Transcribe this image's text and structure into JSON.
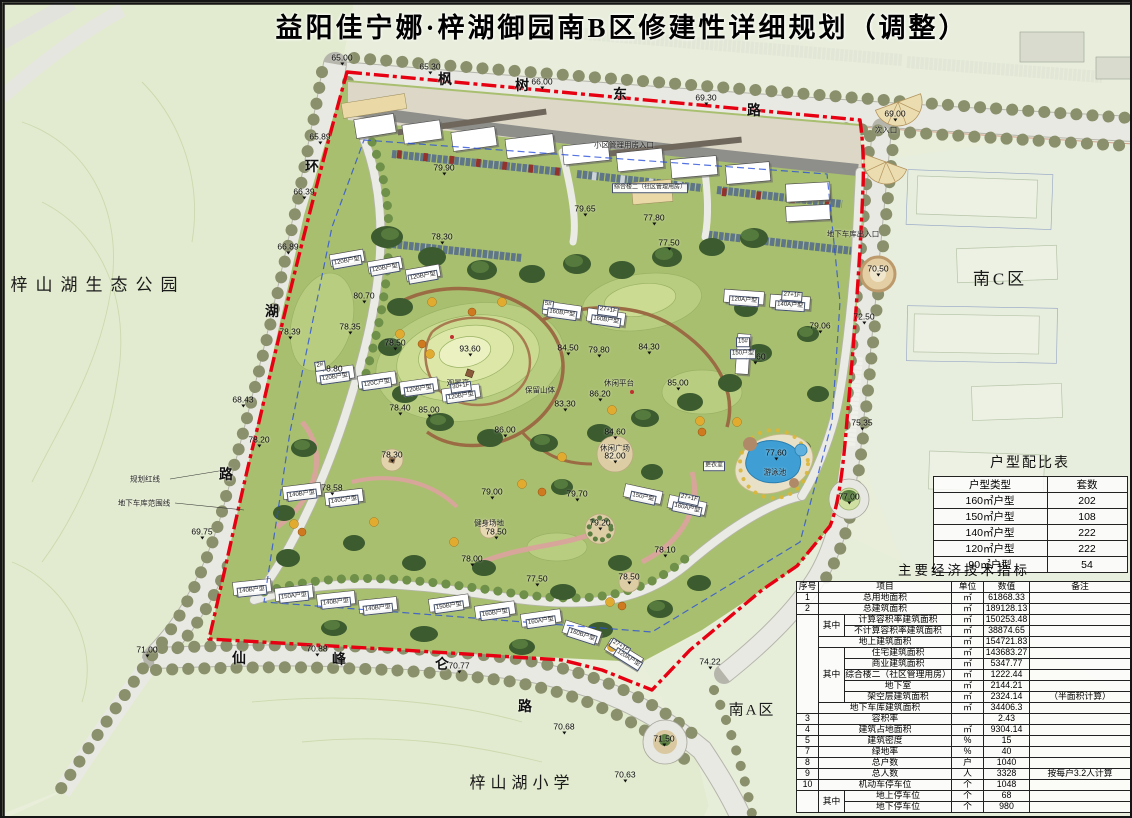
{
  "title": "益阳佳宁娜·梓湖御园南B区修建性详细规划（调整）",
  "colors": {
    "boundary_red": "#e60012",
    "garage_blue": "#2b50d9",
    "pool_blue": "#3f9fd4"
  },
  "area_labels": [
    {
      "t": "梓山湖生态公园",
      "x": 96,
      "y": 281,
      "fs": 17,
      "ls": 8
    },
    {
      "t": "南C区",
      "x": 998,
      "y": 275,
      "fs": 17,
      "ls": 3
    },
    {
      "t": "南A区",
      "x": 750,
      "y": 707,
      "fs": 15,
      "ls": 2
    },
    {
      "t": "梓山湖小学",
      "x": 520,
      "y": 779,
      "fs": 16,
      "ls": 5
    }
  ],
  "road_labels": [
    {
      "t": "枫",
      "x": 443,
      "y": 77
    },
    {
      "t": "树",
      "x": 520,
      "y": 83
    },
    {
      "t": "东",
      "x": 618,
      "y": 92
    },
    {
      "t": "路",
      "x": 752,
      "y": 108
    },
    {
      "t": "环",
      "x": 310,
      "y": 164
    },
    {
      "t": "湖",
      "x": 270,
      "y": 309
    },
    {
      "t": "路",
      "x": 224,
      "y": 472
    },
    {
      "t": "仙",
      "x": 237,
      "y": 656
    },
    {
      "t": "峰",
      "x": 337,
      "y": 657
    },
    {
      "t": "仑",
      "x": 440,
      "y": 662
    },
    {
      "t": "路",
      "x": 523,
      "y": 704
    }
  ],
  "note_labels": [
    {
      "t": "规划红线",
      "x": 143,
      "y": 477
    },
    {
      "t": "地下车库范围线",
      "x": 142,
      "y": 501
    },
    {
      "t": "游泳池",
      "x": 773,
      "y": 470
    },
    {
      "t": "休闲广场",
      "x": 613,
      "y": 446
    },
    {
      "t": "健身场地",
      "x": 487,
      "y": 521
    },
    {
      "t": "观景亭",
      "x": 456,
      "y": 381
    },
    {
      "t": "保留山体",
      "x": 538,
      "y": 388
    },
    {
      "t": "休闲平台",
      "x": 617,
      "y": 381
    },
    {
      "t": "次入口",
      "x": 884,
      "y": 128
    },
    {
      "t": "小区管理用房入口",
      "x": 622,
      "y": 143
    },
    {
      "t": "地下车库出入口",
      "x": 851,
      "y": 232
    },
    {
      "t": "更衣室",
      "x": 712,
      "y": 464,
      "cls": "bldg"
    },
    {
      "t": "综合楼二（社区管理用房）",
      "x": 648,
      "y": 186,
      "cls": "bldg"
    }
  ],
  "elevations": [
    {
      "t": "65.00",
      "x": 340,
      "y": 57
    },
    {
      "t": "65.30",
      "x": 428,
      "y": 66
    },
    {
      "t": "66.00",
      "x": 540,
      "y": 81
    },
    {
      "t": "69.30",
      "x": 704,
      "y": 97
    },
    {
      "t": "69.00",
      "x": 893,
      "y": 113
    },
    {
      "t": "65.89",
      "x": 318,
      "y": 136
    },
    {
      "t": "66.39",
      "x": 302,
      "y": 191
    },
    {
      "t": "66.89",
      "x": 286,
      "y": 246
    },
    {
      "t": "68.43",
      "x": 241,
      "y": 399
    },
    {
      "t": "78.39",
      "x": 288,
      "y": 331
    },
    {
      "t": "78.20",
      "x": 257,
      "y": 439
    },
    {
      "t": "69.75",
      "x": 200,
      "y": 531
    },
    {
      "t": "71.00",
      "x": 145,
      "y": 649
    },
    {
      "t": "70.88",
      "x": 315,
      "y": 648
    },
    {
      "t": "70.77",
      "x": 457,
      "y": 665
    },
    {
      "t": "70.68",
      "x": 562,
      "y": 726
    },
    {
      "t": "70.63",
      "x": 623,
      "y": 774
    },
    {
      "t": "74.22",
      "x": 708,
      "y": 661
    },
    {
      "t": "71.50",
      "x": 662,
      "y": 738
    },
    {
      "t": "70.50",
      "x": 876,
      "y": 268
    },
    {
      "t": "72.50",
      "x": 862,
      "y": 316
    },
    {
      "t": "79.06",
      "x": 818,
      "y": 325
    },
    {
      "t": "75.35",
      "x": 860,
      "y": 422
    },
    {
      "t": "77.00",
      "x": 847,
      "y": 496
    },
    {
      "t": "77.60",
      "x": 774,
      "y": 452
    },
    {
      "t": "79.00",
      "x": 788,
      "y": 302
    },
    {
      "t": "79.60",
      "x": 753,
      "y": 356
    },
    {
      "t": "93.60",
      "x": 468,
      "y": 348
    },
    {
      "t": "84.50",
      "x": 566,
      "y": 347
    },
    {
      "t": "79.80",
      "x": 597,
      "y": 349
    },
    {
      "t": "84.30",
      "x": 647,
      "y": 346
    },
    {
      "t": "86.20",
      "x": 598,
      "y": 393
    },
    {
      "t": "83.30",
      "x": 563,
      "y": 403
    },
    {
      "t": "85.00",
      "x": 676,
      "y": 382
    },
    {
      "t": "84.60",
      "x": 613,
      "y": 431
    },
    {
      "t": "86.00",
      "x": 503,
      "y": 429
    },
    {
      "t": "85.00",
      "x": 427,
      "y": 409
    },
    {
      "t": "82.00",
      "x": 613,
      "y": 455
    },
    {
      "t": "79.70",
      "x": 575,
      "y": 493
    },
    {
      "t": "79.00",
      "x": 490,
      "y": 491
    },
    {
      "t": "78.50",
      "x": 494,
      "y": 531
    },
    {
      "t": "79.20",
      "x": 598,
      "y": 522
    },
    {
      "t": "78.00",
      "x": 470,
      "y": 558
    },
    {
      "t": "77.50",
      "x": 535,
      "y": 578
    },
    {
      "t": "78.10",
      "x": 663,
      "y": 549
    },
    {
      "t": "78.50",
      "x": 627,
      "y": 576
    },
    {
      "t": "78.30",
      "x": 390,
      "y": 454
    },
    {
      "t": "78.40",
      "x": 398,
      "y": 407
    },
    {
      "t": "80.70",
      "x": 362,
      "y": 295
    },
    {
      "t": "78.35",
      "x": 348,
      "y": 326
    },
    {
      "t": "79.90",
      "x": 442,
      "y": 167
    },
    {
      "t": "78.30",
      "x": 440,
      "y": 236
    },
    {
      "t": "79.65",
      "x": 583,
      "y": 208
    },
    {
      "t": "77.80",
      "x": 652,
      "y": 217
    },
    {
      "t": "77.50",
      "x": 667,
      "y": 242
    },
    {
      "t": "78.50",
      "x": 393,
      "y": 342
    },
    {
      "t": "78.80",
      "x": 330,
      "y": 368
    },
    {
      "t": "78.58",
      "x": 330,
      "y": 487
    }
  ],
  "bldg_labels": [
    {
      "t": "120B户型",
      "x": 345,
      "y": 260,
      "r": -10
    },
    {
      "t": "120B户型",
      "x": 383,
      "y": 267,
      "r": -10
    },
    {
      "t": "120B户型",
      "x": 421,
      "y": 275,
      "r": -10
    },
    {
      "t": "2#",
      "x": 318,
      "y": 364,
      "r": -8
    },
    {
      "t": "120B户型",
      "x": 333,
      "y": 376,
      "r": -8
    },
    {
      "t": "120C户型",
      "x": 375,
      "y": 382,
      "r": -8
    },
    {
      "t": "120B户型",
      "x": 417,
      "y": 388,
      "r": -8
    },
    {
      "t": "30+1F",
      "x": 459,
      "y": 385,
      "r": -8
    },
    {
      "t": "120B户型",
      "x": 459,
      "y": 395,
      "r": -8
    },
    {
      "t": "140B户型",
      "x": 300,
      "y": 493,
      "r": -7
    },
    {
      "t": "140C户型",
      "x": 342,
      "y": 499,
      "r": -7
    },
    {
      "t": "140B户型",
      "x": 250,
      "y": 589,
      "r": -6
    },
    {
      "t": "150A户型",
      "x": 292,
      "y": 595,
      "r": -6
    },
    {
      "t": "140B户型",
      "x": 334,
      "y": 601,
      "r": -6
    },
    {
      "t": "140B户型",
      "x": 376,
      "y": 607,
      "r": -6
    },
    {
      "t": "150B户型",
      "x": 447,
      "y": 605,
      "r": -8
    },
    {
      "t": "160B户型",
      "x": 493,
      "y": 612,
      "r": -8
    },
    {
      "t": "160A户型",
      "x": 539,
      "y": 620,
      "r": -8
    },
    {
      "t": "160B户型",
      "x": 580,
      "y": 634,
      "r": 18
    },
    {
      "t": "27+1F",
      "x": 618,
      "y": 645,
      "r": 32
    },
    {
      "t": "120A户型",
      "x": 626,
      "y": 657,
      "r": 32
    },
    {
      "t": "150户型",
      "x": 641,
      "y": 496,
      "r": 12
    },
    {
      "t": "27+1F",
      "x": 687,
      "y": 497,
      "r": 12
    },
    {
      "t": "160A户型",
      "x": 685,
      "y": 507,
      "r": 12
    },
    {
      "t": "5#",
      "x": 546,
      "y": 303,
      "r": 8
    },
    {
      "t": "160B户型",
      "x": 560,
      "y": 312,
      "r": 8
    },
    {
      "t": "27+1F",
      "x": 606,
      "y": 309,
      "r": 8
    },
    {
      "t": "160B户型",
      "x": 604,
      "y": 319,
      "r": 8
    },
    {
      "t": "27+1F",
      "x": 790,
      "y": 294,
      "r": 4
    },
    {
      "t": "120A户型",
      "x": 742,
      "y": 299,
      "r": 4
    },
    {
      "t": "140A户型",
      "x": 788,
      "y": 304,
      "r": 4
    },
    {
      "t": "15#",
      "x": 741,
      "y": 340,
      "r": 0
    },
    {
      "t": "150户型",
      "x": 741,
      "y": 352,
      "r": 0
    }
  ],
  "unit_table": {
    "title": "户型配比表",
    "cols": [
      114,
      80
    ],
    "header": [
      "户型类型",
      "套数"
    ],
    "rows": [
      [
        "160㎡户型",
        "202"
      ],
      [
        "150㎡户型",
        "108"
      ],
      [
        "140㎡户型",
        "222"
      ],
      [
        "120㎡户型",
        "222"
      ],
      [
        "90㎡户型",
        "54"
      ]
    ]
  },
  "indicators": {
    "title": "主要经济技术指标",
    "cols": [
      22,
      26,
      30,
      77,
      32,
      46,
      101
    ],
    "header": [
      "序号",
      {
        "t": "项目",
        "c": 3
      },
      "单位",
      "数值",
      "备注"
    ],
    "rows": [
      [
        "1",
        {
          "t": "总用地面积",
          "c": 3
        },
        "㎡",
        "61868.33",
        ""
      ],
      [
        "2",
        {
          "t": "总建筑面积",
          "c": 3
        },
        "㎡",
        "189128.13",
        ""
      ],
      [
        {
          "t": "",
          "r": 9
        },
        {
          "t": "其中",
          "r": 2
        },
        {
          "t": "计算容积率建筑面积",
          "c": 2
        },
        "㎡",
        "150253.48",
        ""
      ],
      [
        {
          "t": "不计算容积率建筑面积",
          "c": 2
        },
        "㎡",
        "38874.65",
        ""
      ],
      [
        {
          "t": "地上建筑面积",
          "c": 3
        },
        "㎡",
        "154721.83",
        ""
      ],
      [
        {
          "t": "其中",
          "r": 5
        },
        {
          "t": "住宅建筑面积",
          "c": 2
        },
        "㎡",
        "143683.27",
        ""
      ],
      [
        {
          "t": "商业建筑面积",
          "c": 2
        },
        "㎡",
        "5347.77",
        ""
      ],
      [
        {
          "t": "综合楼二（社区管理用房）",
          "c": 2
        },
        "㎡",
        "1222.44",
        ""
      ],
      [
        {
          "t": "地下室",
          "c": 2
        },
        "㎡",
        "2144.21",
        ""
      ],
      [
        {
          "t": "架空层建筑面积",
          "c": 2
        },
        "㎡",
        "2324.14",
        "（半面积计算）"
      ],
      [
        {
          "t": "地下车库建筑面积",
          "c": 3
        },
        "㎡",
        "34406.3",
        ""
      ],
      [
        "3",
        {
          "t": "容积率",
          "c": 3
        },
        "",
        "2.43",
        ""
      ],
      [
        "4",
        {
          "t": "建筑占地面积",
          "c": 3
        },
        "㎡",
        "9304.14",
        ""
      ],
      [
        "5",
        {
          "t": "建筑密度",
          "c": 3
        },
        "%",
        "15",
        ""
      ],
      [
        "7",
        {
          "t": "绿地率",
          "c": 3
        },
        "%",
        "40",
        ""
      ],
      [
        "8",
        {
          "t": "总户数",
          "c": 3
        },
        "户",
        "1040",
        ""
      ],
      [
        "9",
        {
          "t": "总人数",
          "c": 3
        },
        "人",
        "3328",
        "按每户3.2人计算"
      ],
      [
        "10",
        {
          "t": "机动车停车位",
          "c": 3
        },
        "个",
        "1048",
        ""
      ],
      [
        {
          "t": "",
          "r": 2
        },
        {
          "t": "其中",
          "r": 2
        },
        {
          "t": "地上停车位",
          "c": 2
        },
        "个",
        "68",
        ""
      ],
      [
        {
          "t": "地下停车位",
          "c": 2
        },
        "个",
        "980",
        ""
      ]
    ]
  }
}
